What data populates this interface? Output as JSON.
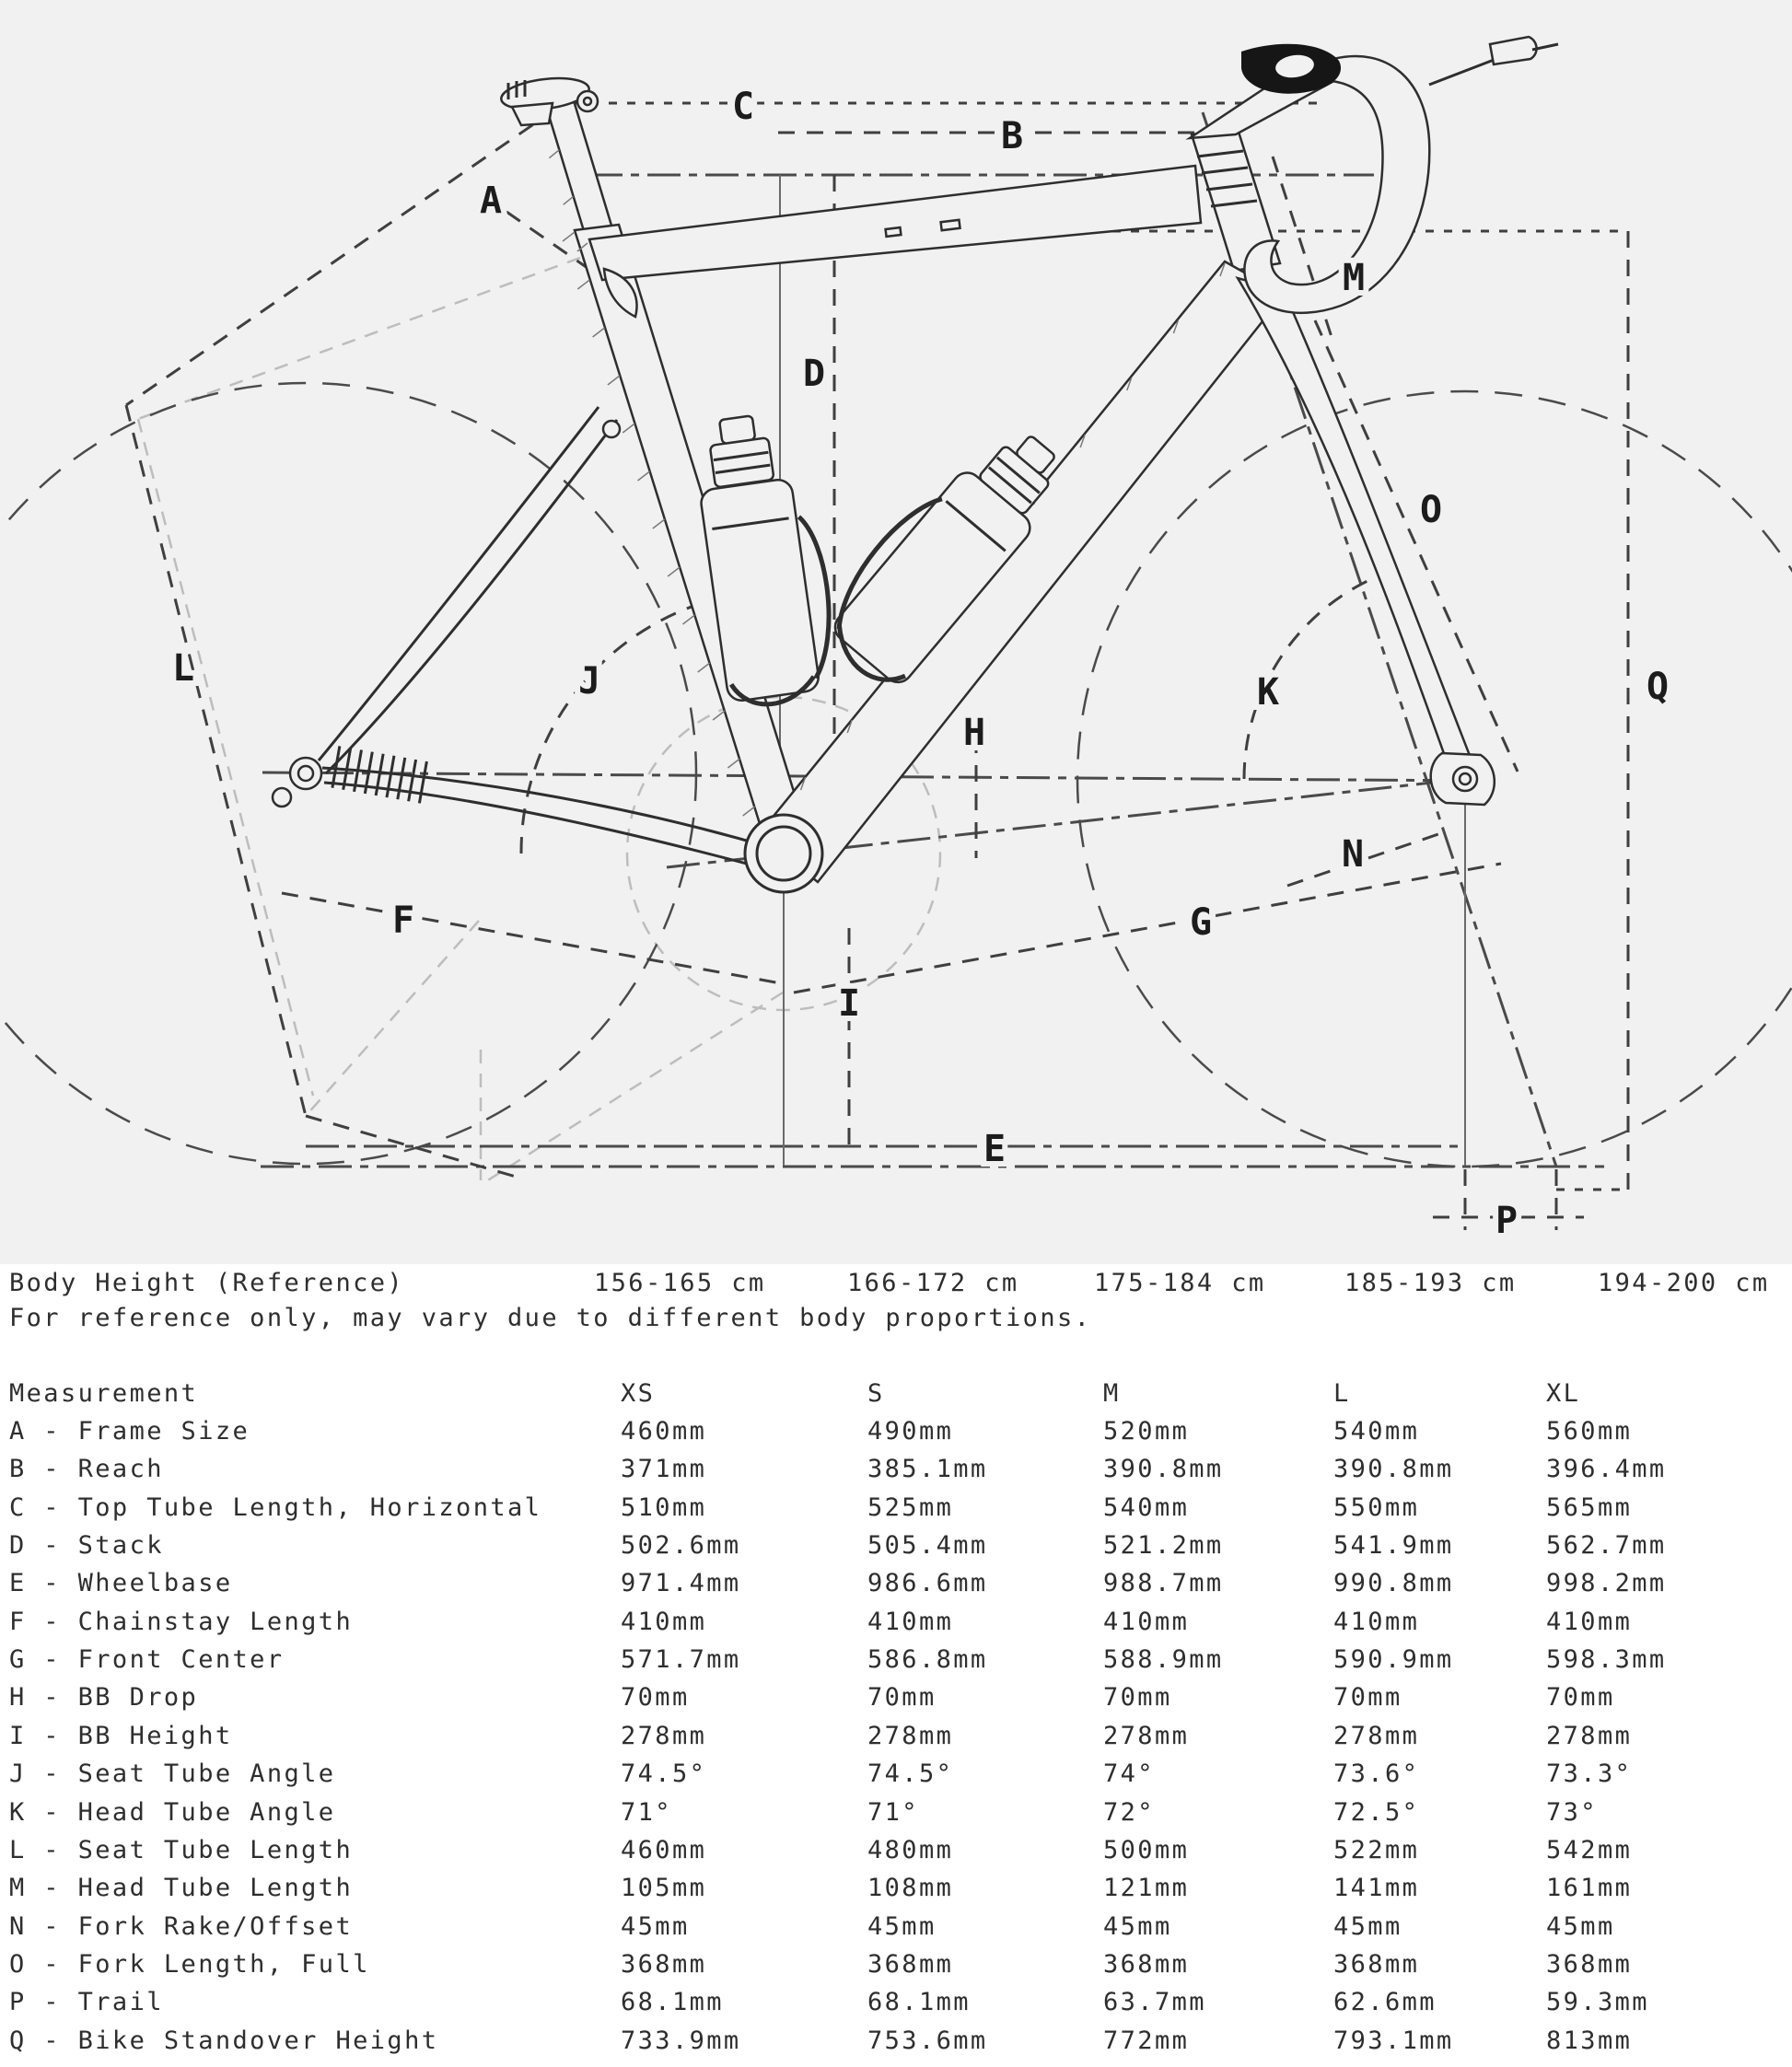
{
  "diagram": {
    "labels": {
      "A": "A",
      "B": "B",
      "C": "C",
      "D": "D",
      "E": "E",
      "F": "F",
      "G": "G",
      "H": "H",
      "I": "I",
      "J": "J",
      "K": "K",
      "L": "L",
      "M": "M",
      "N": "N",
      "O": "O",
      "P": "P",
      "Q": "Q"
    },
    "colors": {
      "background": "#f1f1f1",
      "paper": "#ffffff",
      "line": "#2e2e2e",
      "construction": "#3f3f3f",
      "light_construction": "#bdbdbd",
      "text": "#1c1c1c"
    }
  },
  "body_height": {
    "label": "Body Height (Reference)",
    "values": [
      "156-165 cm",
      "166-172 cm",
      "175-184 cm",
      "185-193 cm",
      "194-200 cm"
    ],
    "note": "For reference only, may vary due to different body proportions."
  },
  "table": {
    "header": [
      "Measurement",
      "XS",
      "S",
      "M",
      "L",
      "XL"
    ],
    "rows": [
      {
        "label": "A - Frame Size",
        "values": [
          "460mm",
          "490mm",
          "520mm",
          "540mm",
          "560mm"
        ]
      },
      {
        "label": "B - Reach",
        "values": [
          "371mm",
          "385.1mm",
          "390.8mm",
          "390.8mm",
          "396.4mm"
        ]
      },
      {
        "label": "C - Top Tube Length, Horizontal",
        "values": [
          "510mm",
          "525mm",
          "540mm",
          "550mm",
          "565mm"
        ]
      },
      {
        "label": "D - Stack",
        "values": [
          "502.6mm",
          "505.4mm",
          "521.2mm",
          "541.9mm",
          "562.7mm"
        ]
      },
      {
        "label": "E - Wheelbase",
        "values": [
          "971.4mm",
          "986.6mm",
          "988.7mm",
          "990.8mm",
          "998.2mm"
        ]
      },
      {
        "label": "F - Chainstay Length",
        "values": [
          "410mm",
          "410mm",
          "410mm",
          "410mm",
          "410mm"
        ]
      },
      {
        "label": "G - Front Center",
        "values": [
          "571.7mm",
          "586.8mm",
          "588.9mm",
          "590.9mm",
          "598.3mm"
        ]
      },
      {
        "label": "H - BB Drop",
        "values": [
          "70mm",
          "70mm",
          "70mm",
          "70mm",
          "70mm"
        ]
      },
      {
        "label": "I - BB Height",
        "values": [
          "278mm",
          "278mm",
          "278mm",
          "278mm",
          "278mm"
        ]
      },
      {
        "label": "J - Seat Tube Angle",
        "values": [
          "74.5°",
          "74.5°",
          "74°",
          "73.6°",
          "73.3°"
        ]
      },
      {
        "label": "K - Head Tube Angle",
        "values": [
          "71°",
          "71°",
          "72°",
          "72.5°",
          "73°"
        ]
      },
      {
        "label": "L - Seat Tube Length",
        "values": [
          "460mm",
          "480mm",
          "500mm",
          "522mm",
          "542mm"
        ]
      },
      {
        "label": "M - Head Tube Length",
        "values": [
          "105mm",
          "108mm",
          "121mm",
          "141mm",
          "161mm"
        ]
      },
      {
        "label": "N - Fork Rake/Offset",
        "values": [
          "45mm",
          "45mm",
          "45mm",
          "45mm",
          "45mm"
        ]
      },
      {
        "label": "O - Fork Length, Full",
        "values": [
          "368mm",
          "368mm",
          "368mm",
          "368mm",
          "368mm"
        ]
      },
      {
        "label": "P - Trail",
        "values": [
          "68.1mm",
          "68.1mm",
          "63.7mm",
          "62.6mm",
          "59.3mm"
        ]
      },
      {
        "label": "Q - Bike Standover Height",
        "values": [
          "733.9mm",
          "753.6mm",
          "772mm",
          "793.1mm",
          "813mm"
        ]
      }
    ]
  }
}
